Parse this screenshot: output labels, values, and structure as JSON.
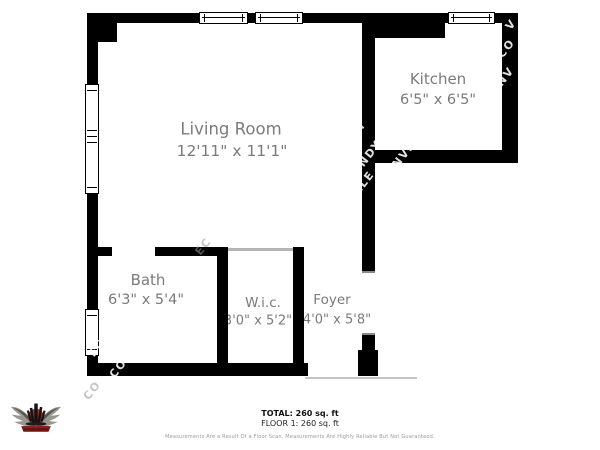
{
  "floor_plan": {
    "rooms": [
      {
        "name": "Living Room",
        "dimensions": "12'11\" x 11'1\""
      },
      {
        "name": "Kitchen",
        "dimensions": "6'5\" x 6'5\""
      },
      {
        "name": "Bath",
        "dimensions": "6'3\" x 5'4\""
      },
      {
        "name": "W.i.c.",
        "dimensions": "3'0\" x 5'2\""
      },
      {
        "name": "Foyer",
        "dimensions": "4'0\" x 5'8\""
      }
    ]
  },
  "summary": {
    "total": "TOTAL: 260 sq. ft",
    "floor": "FLOOR 1: 260 sq. ft",
    "disclaimer": "Measurements Are a Result Of a Floor Scan, Measurements Are Highly Reliable But Not Guaranteed."
  },
  "watermark": {
    "fragments": [
      "V",
      "CO",
      "NV",
      "ETI",
      "NDY",
      "NVE",
      "LLE",
      "VIE",
      "CO",
      "ECT",
      "CO",
      "EC"
    ]
  },
  "logo": {
    "icon": "winged-skyline-emblem-logo"
  },
  "colors": {
    "wall": "#000000",
    "room_label": "#7b7b7b",
    "summary_text": "#111111",
    "disclaimer_text": "#a39595",
    "watermark": "#ffffff",
    "logo_accent": "#b5342a"
  }
}
